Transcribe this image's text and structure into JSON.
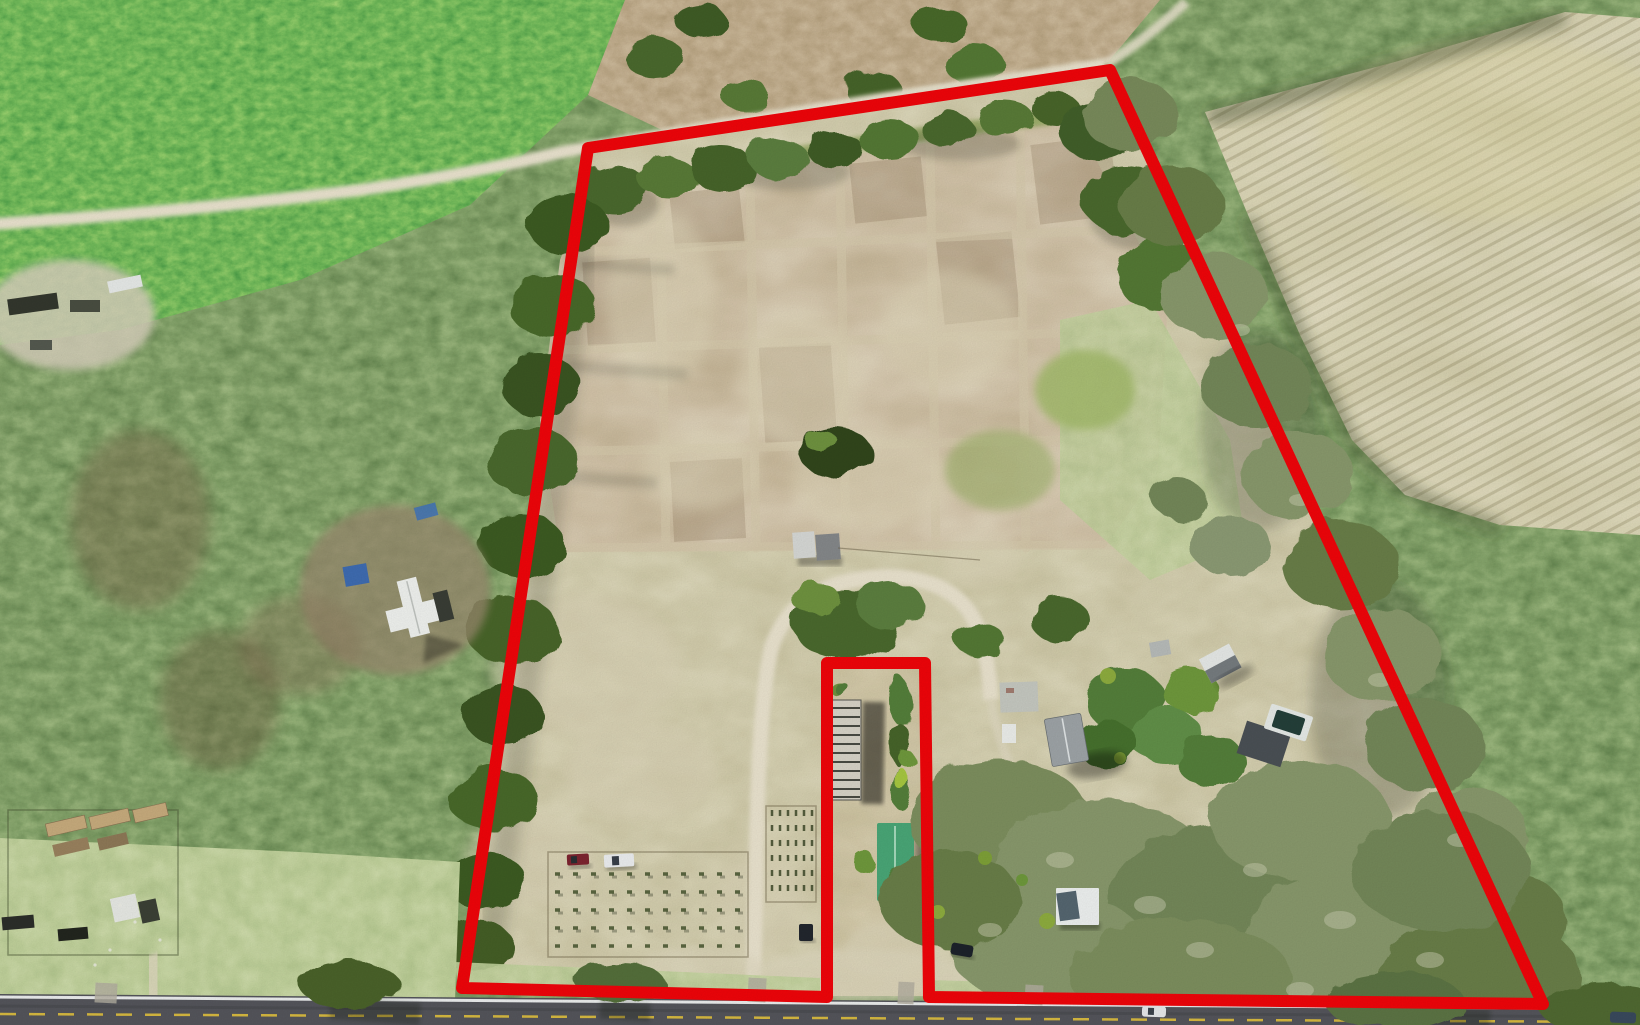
{
  "image": {
    "type": "aerial-drone-photograph",
    "subject": "rural acreage parcel with property boundary outline",
    "width_px": 1640,
    "height_px": 1025
  },
  "annotation": {
    "kind": "property-boundary-outline",
    "shape": "trapezoid widening toward road with rectangular exclusion notch at bottom center",
    "style": "thick solid line, rounded corners"
  },
  "colors": {
    "boundary_red": "#f2050a",
    "asphalt": "#55565c",
    "road_edge_line": "#eef0f0",
    "road_center_line": "#d9bb41",
    "sand_path": "#ece5d0",
    "gravel": "#a7aaa6",
    "pine_green": "#2f8127",
    "woods_green": "#4a6a2d",
    "sage_green": "#8d9c74",
    "field_tan": "#a8906c",
    "grid_sand": "#d9cdaf",
    "pasture_olive": "#a89c72",
    "crop_field_gold": "#c2b883",
    "lawn_green": "#93a964",
    "scrub_brown": "#8a6d49",
    "green_roof": "#4aa878",
    "white_roof": "#f2f4f1",
    "gray_roof": "#9fa5a8",
    "concrete": "#c6c9c3",
    "pool_water": "#24403a",
    "tarp_blue": "#3f6db3",
    "truck_maroon": "#7e2430",
    "truck_white": "#eef0f2",
    "vehicle_dark": "#22272e",
    "trailer_tan": "#c9ad7e",
    "shrub_dark": "#31471f"
  },
  "scene": {
    "landcover": [
      "dense pine plantation (top left)",
      "brown scrub pasture (top center)",
      "mowed hay field with diagonal wheel lines (top right)",
      "plowed field divided into bed grid by sandy lanes (center)",
      "open pasture with sandy patches (center south)",
      "oak and moss canopy (southeast)",
      "lawn with utility trailer yard (bottom left)"
    ],
    "routes": [
      "white sand road along north boundary",
      "U-shaped sand driveway from paved road",
      "gravel loop drive near road (southeast)",
      "two-lane paved road across bottom"
    ],
    "structures": [
      "white metal-roof farmhouse (west, outside boundary)",
      "blue tarps near farmhouse",
      "pair of equipment sheds (center)",
      "old greenhouse frame (inside notch)",
      "long green metal-roof barn (inside notch)",
      "concrete slab",
      "small white shed",
      "gray shingle-roof house (east)",
      "white gable outbuilding (east)",
      "pool with white deck and dark outbuilding (east)",
      "white-roof shed near road (southeast)",
      "row of tan utility trailers (bottom left)",
      "white canopy tent (bottom left)"
    ],
    "vehicles": [
      "maroon pickup in field",
      "white pickup in field",
      "dark pickup near notch",
      "dark sedan near gravel drive",
      "white car on paved road",
      "dark car on paved road (far right)"
    ],
    "plantings": [
      "young orchard rows (bottom left inside boundary)",
      "fenced garden rows west of notch",
      "orchard rows east of notch"
    ]
  }
}
